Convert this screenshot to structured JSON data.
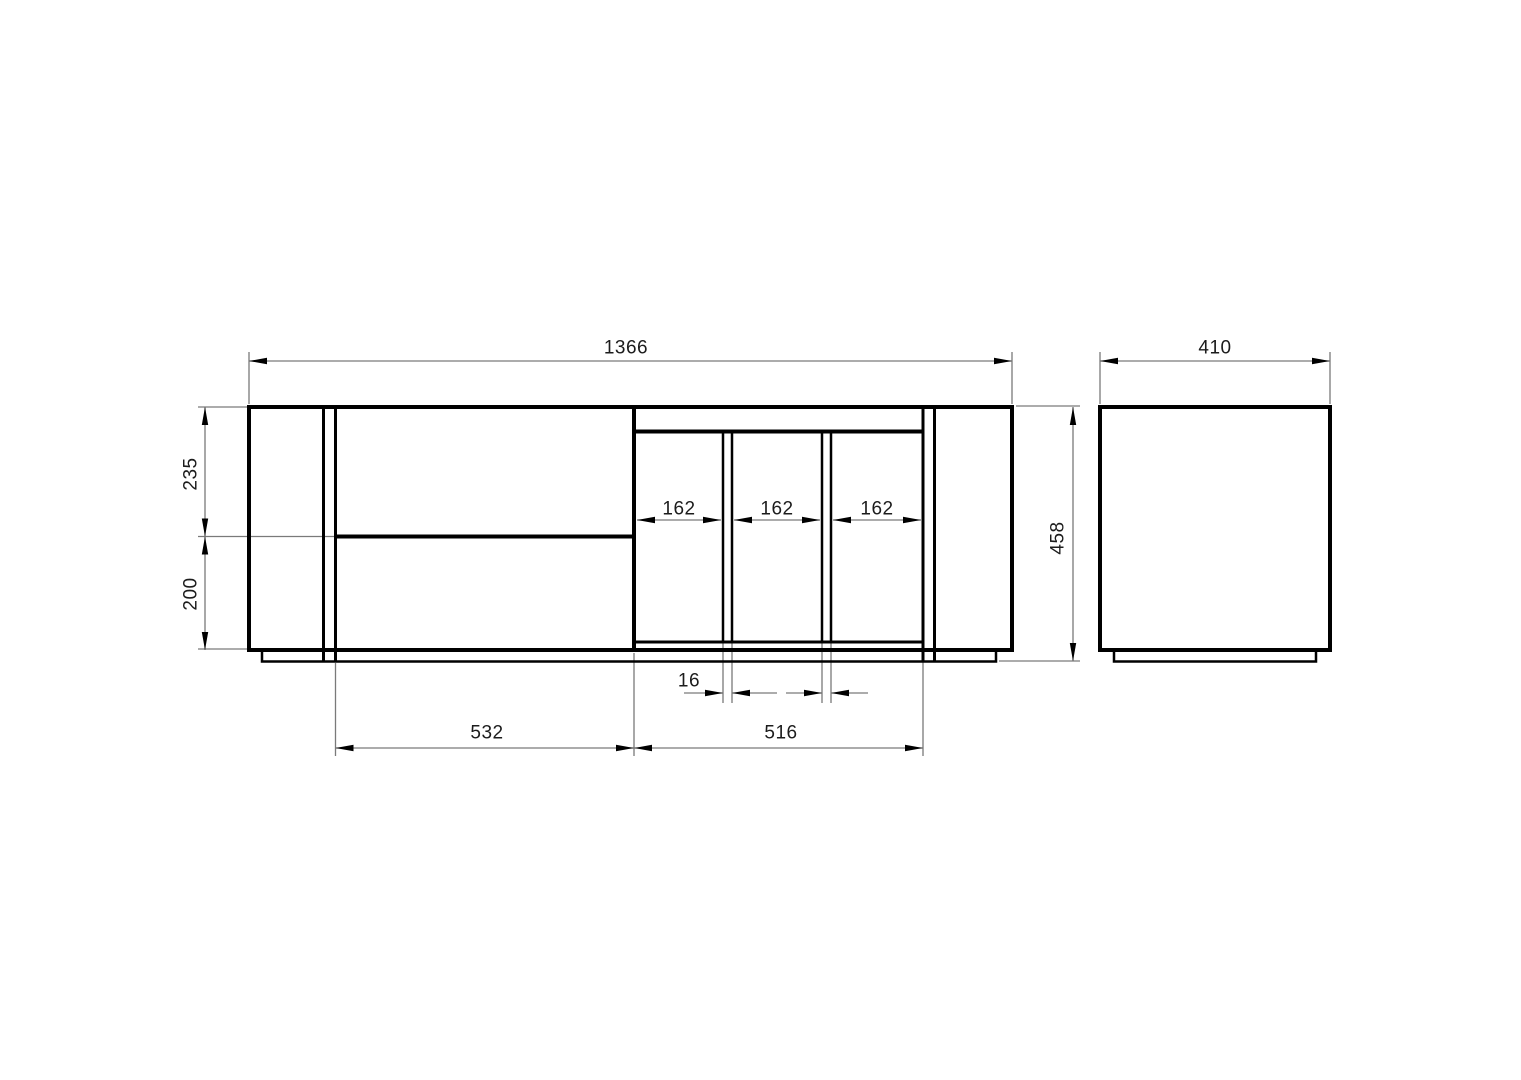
{
  "drawing": {
    "type": "furniture-dimension-drawing",
    "views": [
      "front-elevation",
      "side-elevation"
    ],
    "units_note": "",
    "colors": {
      "background": "#ffffff",
      "outline": "#000000",
      "dimension_lines": "#7a7a7a",
      "text": "#1c1c1c"
    }
  },
  "dimensions": {
    "overall_width": "1366",
    "depth": "410",
    "overall_height": "458",
    "upper_front_height": "235",
    "lower_front_height": "200",
    "compartments": [
      "162",
      "162",
      "162"
    ],
    "divider_thickness": "16",
    "left_section_width": "532",
    "right_section_width": "516"
  }
}
